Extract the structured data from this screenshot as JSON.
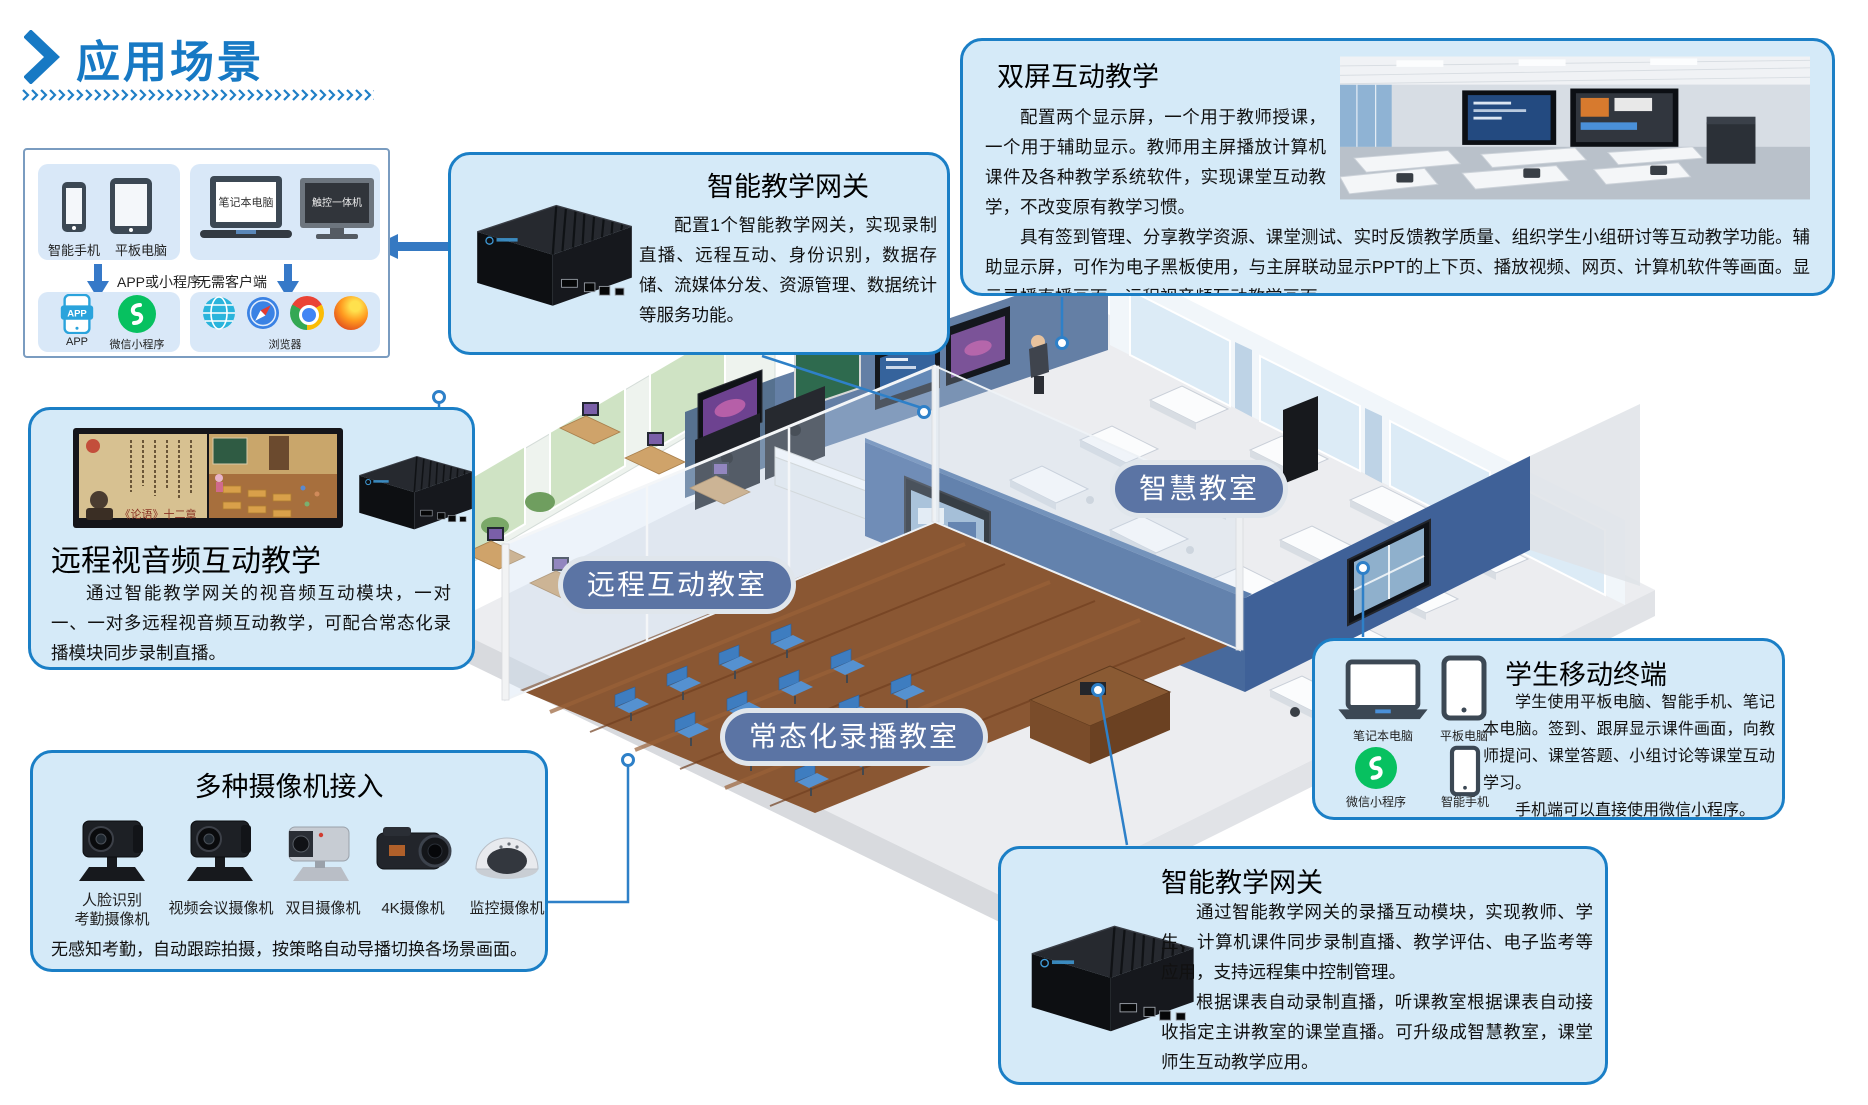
{
  "colors": {
    "accent": "#1779c4",
    "callout_fill": "#d5eaf8",
    "callout_border": "#1b7fc6",
    "pill_fill": "#5b74a4",
    "connector": "#2e80c8",
    "wechat_green": "#07c160",
    "wood_floor": "#8a5733",
    "wall_blue": "#47699c"
  },
  "header": {
    "title": "应用场景"
  },
  "client_box": {
    "devices_a": [
      {
        "icon": "smartphone-icon",
        "label": "智能手机"
      },
      {
        "icon": "tablet-icon",
        "label": "平板电脑"
      }
    ],
    "devices_b": [
      {
        "icon": "laptop-icon",
        "label": "笔记本电脑"
      },
      {
        "icon": "touch-panel-icon",
        "label": "触控一体机"
      }
    ],
    "arrow_a_label": "APP或小程序",
    "arrow_b_label": "无需客户端",
    "apps_a": [
      {
        "icon": "app-icon",
        "label": "APP"
      },
      {
        "icon": "wechat-icon",
        "label": "微信小程序"
      }
    ],
    "apps_b_label": "浏览器",
    "apps_b_icons": [
      "globe-icon",
      "safari-icon",
      "chrome-icon",
      "firefox-icon"
    ]
  },
  "callouts": {
    "gateway_top": {
      "title": "智能教学网关",
      "body": "配置1个智能教学网关，实现录制直播、远程互动、身份识别，数据存储、流媒体分发、资源管理、数据统计等服务功能。"
    },
    "dual_screen": {
      "title": "双屏互动教学",
      "body1": "配置两个显示屏，一个用于教师授课，一个用于辅助显示。教师用主屏播放计算机课件及各种教学系统软件，实现课堂互动教学，不改变原有教学习惯。",
      "body2": "具有签到管理、分享教学资源、课堂测试、实时反馈教学质量、组织学生小组研讨等互动教学功能。辅助显示屏，可作为电子黑板使用，与主屏联动显示PPT的上下页、播放视频、网页、计算机软件等画面。显示录播直播画面、远程视音频互动教学画面。"
    },
    "remote_av": {
      "title": "远程视音频互动教学",
      "screen_caption": "《论语》十二章",
      "body": "通过智能教学网关的视音频互动模块，一对一、一对多远程视音频互动教学，可配合常态化录播模块同步录制直播。"
    },
    "cameras": {
      "title": "多种摄像机接入",
      "items": [
        {
          "icon": "ptz-camera-icon",
          "label": "人脸识别\n考勤摄像机"
        },
        {
          "icon": "ptz-camera-icon",
          "label": "视频会议摄像机"
        },
        {
          "icon": "binocular-camera-icon",
          "label": "双目摄像机"
        },
        {
          "icon": "box-camera-icon",
          "label": "4K摄像机"
        },
        {
          "icon": "dome-camera-icon",
          "label": "监控摄像机"
        }
      ],
      "body": "无感知考勤，自动跟踪拍摄，按策略自动导播切换各场景画面。"
    },
    "student": {
      "title": "学生移动终端",
      "devices": [
        {
          "icon": "laptop-icon",
          "label": "笔记本电脑"
        },
        {
          "icon": "tablet-icon",
          "label": "平板电脑"
        },
        {
          "icon": "wechat-icon",
          "label": "微信小程序"
        },
        {
          "icon": "smartphone-icon",
          "label": "智能手机"
        }
      ],
      "body1": "学生使用平板电脑、智能手机、笔记本电脑。签到、跟屏显示课件画面，向教师提问、课堂答题、小组讨论等课堂互动学习。",
      "body2": "手机端可以直接使用微信小程序。"
    },
    "gateway_bottom": {
      "title": "智能教学网关",
      "body1": "通过智能教学网关的录播互动模块，实现教师、学生、计算机课件同步录制直播、教学评估、电子监考等应用，支持远程集中控制管理。",
      "body2": "根据课表自动录制直播，听课教室根据课表自动接收指定主讲教室的课堂直播。可升级成智慧教室，课堂师生互动教学应用。"
    }
  },
  "rooms": [
    {
      "label": "智慧教室"
    },
    {
      "label": "远程互动教室"
    },
    {
      "label": "常态化录播教室"
    }
  ]
}
